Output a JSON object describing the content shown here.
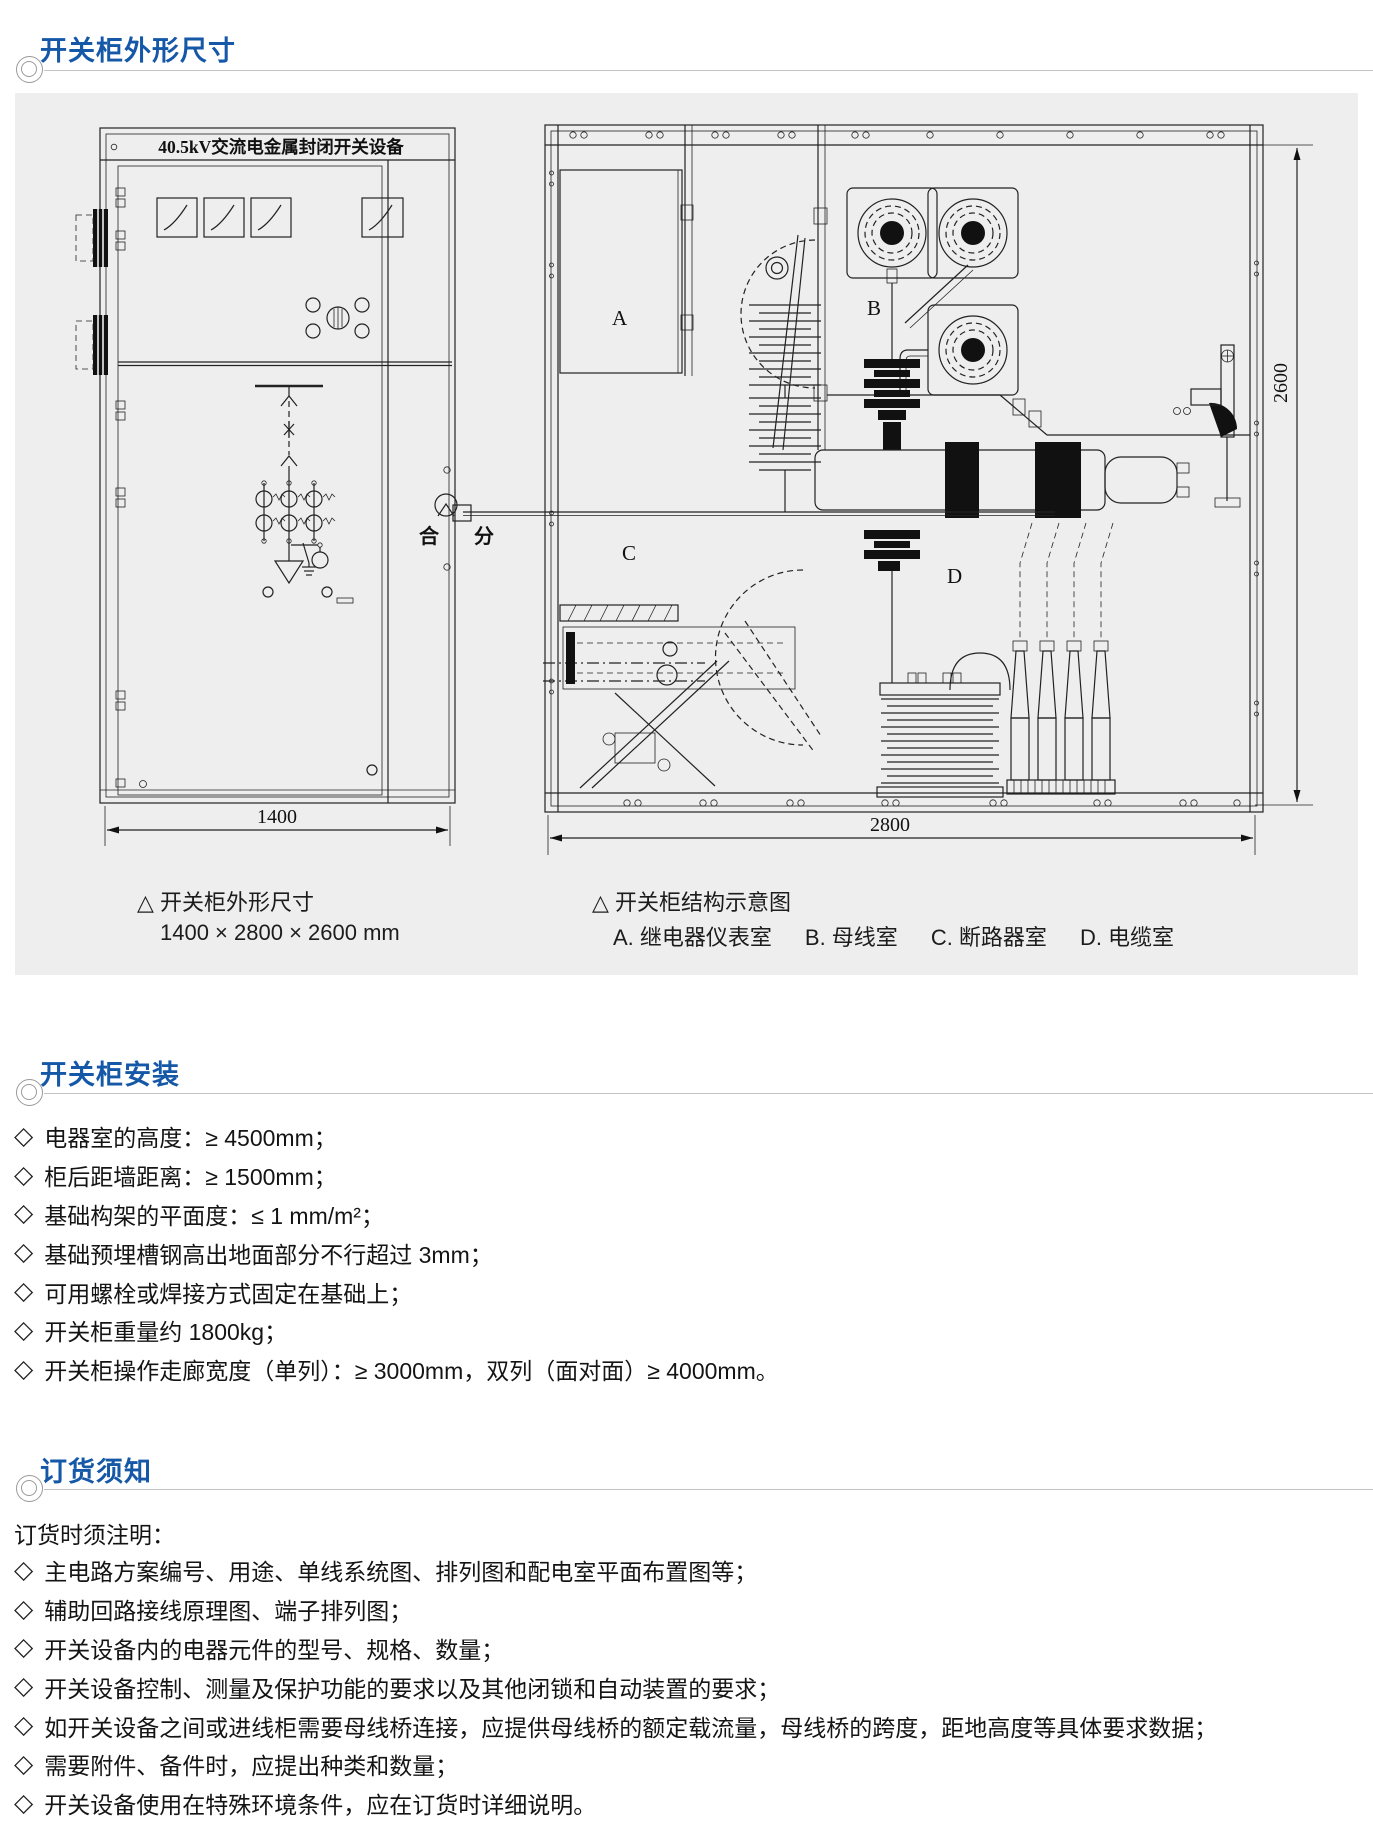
{
  "page": {
    "accent": "#1558a8",
    "panel_bg": "#eeeeef",
    "background": "#ffffff"
  },
  "glyphs": {
    "diamond": "◇"
  },
  "sections": [
    {
      "id": "dimensions",
      "title": "开关柜外形尺寸"
    },
    {
      "id": "installation",
      "title": "开关柜安装",
      "bullets": [
        "电器室的高度：≥ 4500mm；",
        "柜后距墙距离：≥ 1500mm；",
        "基础构架的平面度：≤ 1 mm/m²；",
        "基础预埋槽钢高出地面部分不行超过 3mm；",
        "可用螺栓或焊接方式固定在基础上；",
        "开关柜重量约 1800kg；",
        "开关柜操作走廊宽度（单列）：≥ 3000mm，双列（面对面）≥ 4000mm。"
      ]
    },
    {
      "id": "ordering",
      "title": "订货须知",
      "intro": "订货时须注明：",
      "bullets": [
        "主电路方案编号、用途、单线系统图、排列图和配电室平面布置图等；",
        "辅助回路接线原理图、端子排列图；",
        "开关设备内的电器元件的型号、规格、数量；",
        "开关设备控制、测量及保护功能的要求以及其他闭锁和自动装置的要求；",
        "如开关设备之间或进线柜需要母线桥连接，应提供母线桥的额定载流量，母线桥的跨度，距地高度等具体要求数据；",
        "需要附件、备件时，应提出种类和数量；",
        "开关设备使用在特殊环境条件，应在订货时详细说明。"
      ]
    }
  ],
  "figure": {
    "left": {
      "title": "40.5kV交流电金属封闭开关设备",
      "close_label": "合",
      "open_label": "分",
      "width_dim": "1400",
      "caption_title": "△ 开关柜外形尺寸",
      "caption_sub": "1400 × 2800 × 2600 mm"
    },
    "right": {
      "label_a": "A",
      "label_b": "B",
      "label_c": "C",
      "label_d": "D",
      "width_dim": "2800",
      "height_dim": "2600",
      "caption_title": "△ 开关柜结构示意图",
      "caption_items": [
        "A. 继电器仪表室",
        "B. 母线室",
        "C. 断路器室",
        "D. 电缆室"
      ]
    }
  }
}
